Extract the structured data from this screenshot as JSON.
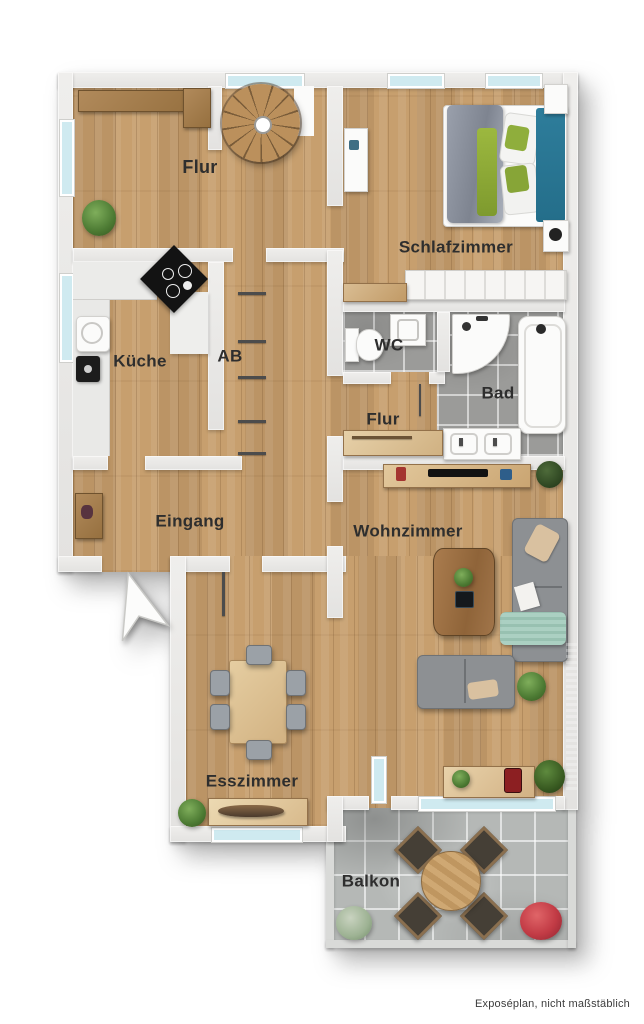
{
  "footer_note": "Exposéplan, nicht maßstäblich",
  "rooms": [
    {
      "id": "flur-top",
      "label": "Flur"
    },
    {
      "id": "schlafzimmer",
      "label": "Schlafzimmer"
    },
    {
      "id": "kueche",
      "label": "Küche"
    },
    {
      "id": "ab",
      "label": "AB"
    },
    {
      "id": "wc",
      "label": "WC"
    },
    {
      "id": "bad",
      "label": "Bad"
    },
    {
      "id": "flur-mitte",
      "label": "Flur"
    },
    {
      "id": "eingang",
      "label": "Eingang"
    },
    {
      "id": "wohnzimmer",
      "label": "Wohnzimmer"
    },
    {
      "id": "esszimmer",
      "label": "Esszimmer"
    },
    {
      "id": "balkon",
      "label": "Balkon"
    }
  ],
  "colors": {
    "floor_wood": "#c79f6e",
    "wall": "#e9e8e6",
    "tile_bath": "#9b9b99",
    "tile_balcony": "#b5b8b6",
    "window_glass": "#cfeaf0",
    "sofa_gray": "#8d9093",
    "bed_teal": "#2e7d9b",
    "bed_lime": "#8fae3c",
    "label_text": "#2e2e2e"
  },
  "furniture": [
    "spiral-staircase",
    "double-bed",
    "wardrobe",
    "kitchen-counter",
    "stove",
    "sink",
    "toilet",
    "shower",
    "bathtub",
    "double-washbasin",
    "sofa",
    "coffee-table",
    "dining-table",
    "dining-chairs",
    "sideboard",
    "balcony-table",
    "balcony-chairs",
    "plants",
    "entrance-arrow"
  ]
}
